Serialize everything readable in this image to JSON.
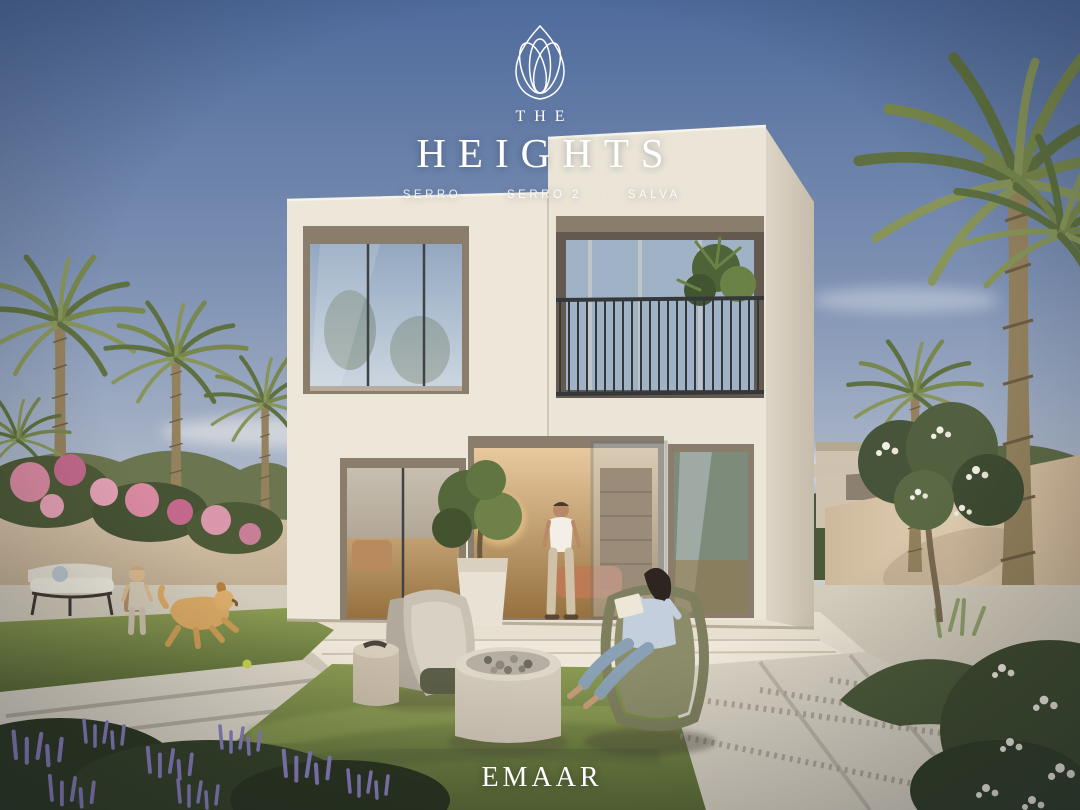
{
  "brand": {
    "logo_icon": "lotus-arches-icon",
    "name_top": "THE",
    "name_main": "HEIGHTS",
    "separator": "·",
    "communities": [
      "SERRO",
      "SERRO 2",
      "SALVA"
    ],
    "developer": "EMAAR"
  },
  "palette": {
    "sky_top": "#51699a",
    "sky_mid": "#8496b5",
    "sky_horizon": "#edeae2",
    "facade_light": "#ece6d9",
    "facade_shade": "#d6cec0",
    "recess_taupe": "#8a7d6c",
    "glass_blue": "#a3b6ca",
    "railing_dark": "#34383a",
    "lawn_green": "#7c8b4a",
    "palm_green": "#6e7f49",
    "wall_beige": "#d4c0a5",
    "bougainvillea_pink": "#d789a0",
    "lavender_purple": "#8a7fbe",
    "paver_light": "#d9d3c6",
    "text_white": "#ffffff"
  },
  "scene": {
    "subject": "two-storey modern villa at dusk with garden, palm trees, family and golden retriever",
    "elements": [
      "villa-facade",
      "balcony-railing",
      "balcony-plant",
      "open-glass-door",
      "man-at-door",
      "woman-reading-book",
      "wicker-armchair",
      "lounge-chairs",
      "fire-pit",
      "concrete-stool",
      "potted-tree",
      "garden-bench",
      "toddler",
      "golden-retriever",
      "tennis-ball",
      "date-palms",
      "boundary-walls",
      "bougainvillea",
      "frangipani-tree",
      "lavender-bed",
      "white-flower-bush",
      "paver-path",
      "stone-walkway",
      "lawn"
    ]
  }
}
